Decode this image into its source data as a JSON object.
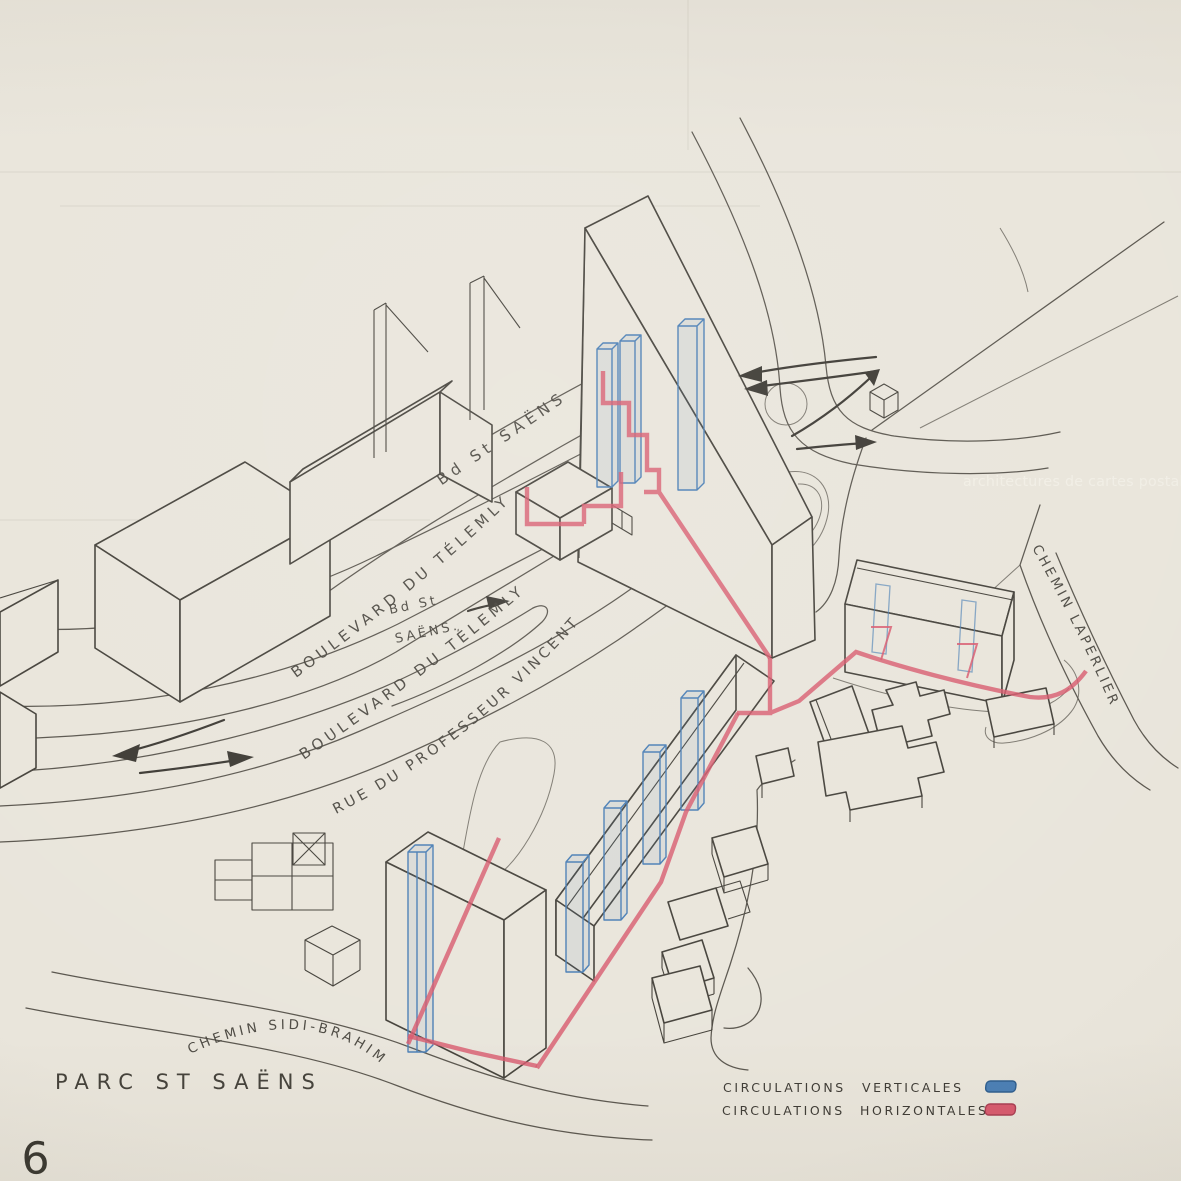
{
  "labels": {
    "bd_st_saens_top": "Bd St SAËNS",
    "boulevard_telemly_1": "BOULEVARD DU TÉLEMLY",
    "bd_st_saens_small_1": "Bd St",
    "bd_st_saens_small_2": "SAËNS.",
    "boulevard_telemly_2": "BOULEVARD DU TÉLEMLY",
    "rue_professeur_vincent": "RUE DU PROFESSEUR VINCENT",
    "chemin_sidi_brahim": "CHEMIN SIDI-BRAHIM",
    "chemin_laperlier": "CHEMIN LAPERLIER",
    "parc_st_saens": "PARC ST SAËNS"
  },
  "legend": {
    "rows": [
      {
        "left": "CIRCULATIONS",
        "right": "VERTICALES",
        "color": "#4b7fb5"
      },
      {
        "left": "CIRCULATIONS",
        "right": "HORIZONTALES",
        "color": "#d85a6e"
      }
    ]
  },
  "page_number": "6",
  "watermark": "architectures de cartes postales",
  "colors": {
    "paper": "#e9e5db",
    "ink": "#45423b",
    "road": "#5a564e",
    "blue": "#4b7fb5",
    "red": "#d85a6e"
  }
}
